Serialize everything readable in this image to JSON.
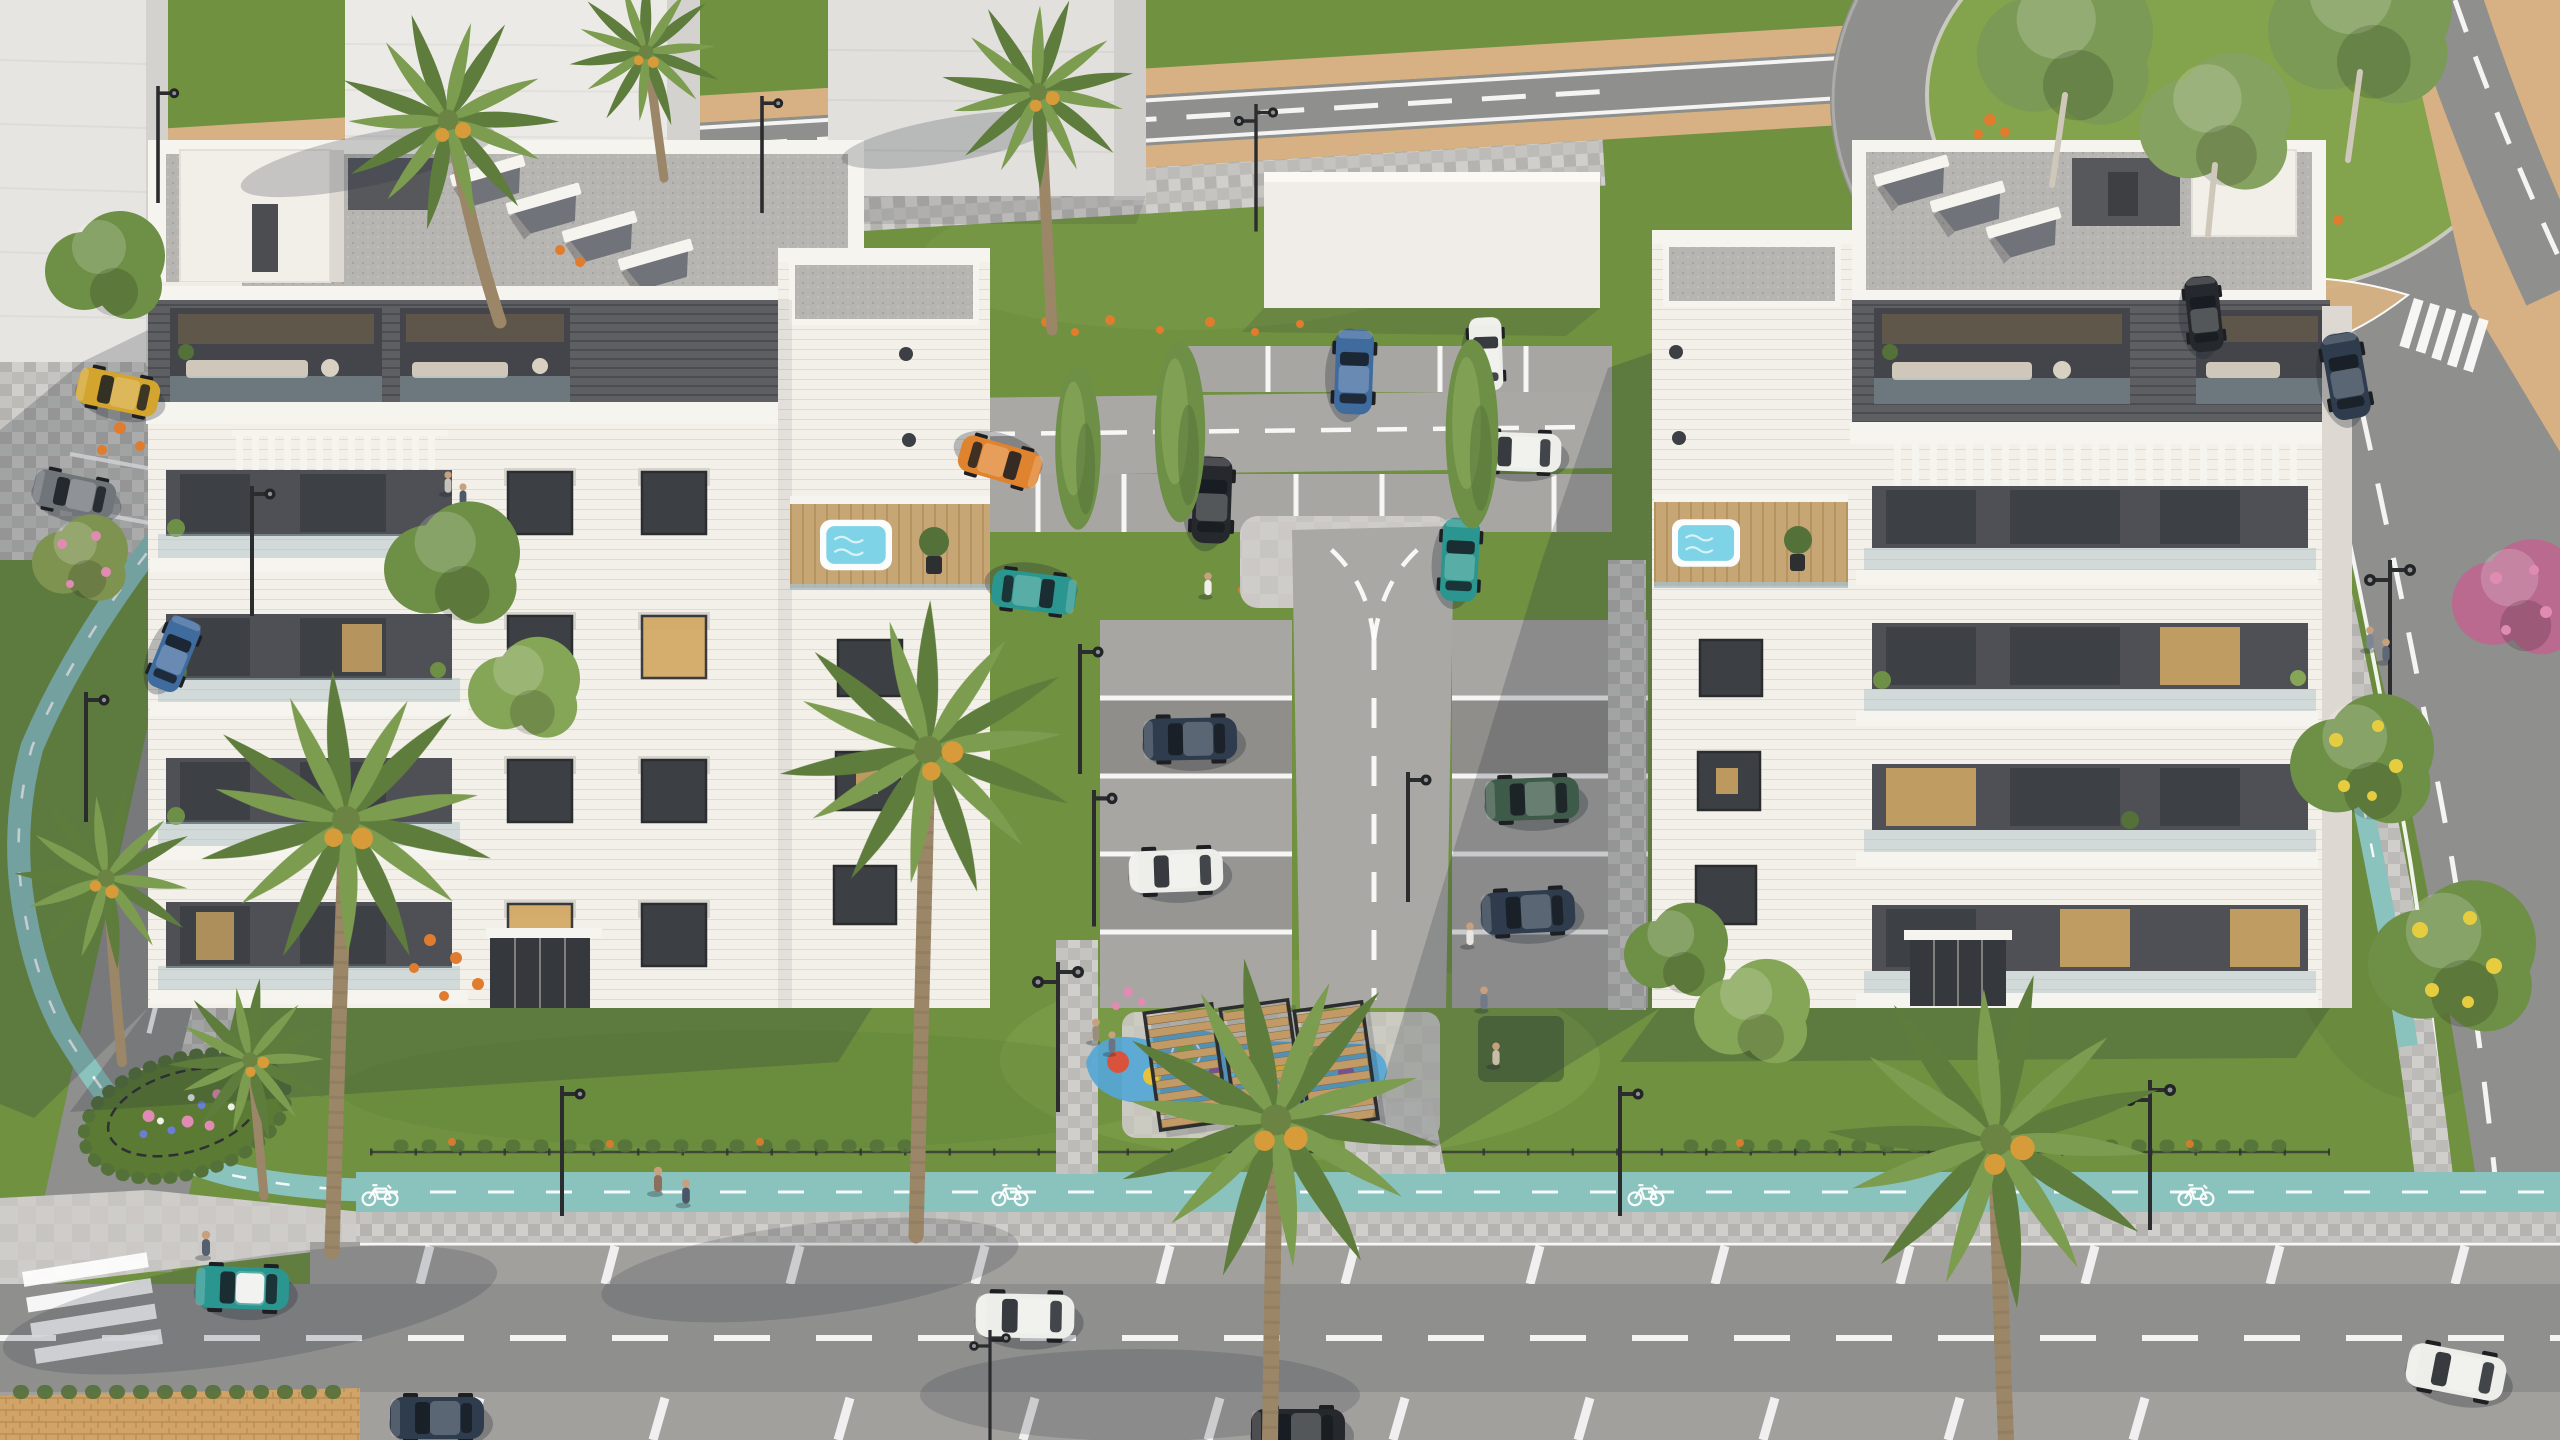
{
  "scene": {
    "title": "Aerial rendering of a residential complex",
    "description": "Photorealistic aerial 3D architectural rendering: two white five-storey apartment buildings with dark-grey penthouse levels, rooftop jacuzzi terraces and balconies, a shared inner courtyard with paved parking, recycling bins, lawns and a colorful playground with wooden pergolas. Surrounded by a boulevard with teal bike lanes, palm trees, a tree-filled roundabout at the top right, sandy median strips, crosswalks, street lamps, parked and driving cars, and pedestrians. No text is visible in the image.",
    "buildings": {
      "count": 2,
      "left_building": "white facade, dark-grey clad upper floors with recessed terraces, rooftop skylights and penthouse volumes, white side tower with jacuzzi terrace, stacked balconies",
      "right_building": "mirrored twin: white tower with jacuzzi terrace on left, dark-grey clad terrace floors, white pergola balcony, window grid with warm lit windows",
      "background_massing": "flat untextured light-grey block buildings along the top edge"
    },
    "landscape": {
      "roundabout": "grass center with eucalyptus trees, top right",
      "bike_lanes": "teal painted lanes with white dashes and bicycle symbols along the bottom boulevard, left road and right road",
      "playground": "blue painted ground game with colored circles under three wooden slatted pergolas",
      "palms": 9,
      "recycling_bins": [
        "orange",
        "green",
        "green"
      ]
    },
    "vehicles": [
      {
        "color": "orange",
        "where": "courtyard bay, left"
      },
      {
        "color": "teal",
        "where": "courtyard, lower left bay"
      },
      {
        "color": "steel-blue SUV",
        "where": "courtyard top bay"
      },
      {
        "color": "white sedan",
        "where": "courtyard road, right"
      },
      {
        "color": "white van",
        "where": "courtyard top right, behind tree"
      },
      {
        "color": "teal",
        "where": "courtyard bay near bins"
      },
      {
        "color": "black SUV",
        "where": "courtyard center bay"
      },
      {
        "color": "navy sedan",
        "where": "Y-road left bay"
      },
      {
        "color": "white sedan",
        "where": "Y-road left bay lower"
      },
      {
        "color": "dark-green SUV",
        "where": "Y-road right bay"
      },
      {
        "color": "navy sedan",
        "where": "Y-road right bay lower"
      },
      {
        "color": "teal with white roof",
        "where": "bottom road left, driving"
      },
      {
        "color": "white SUV",
        "where": "bottom road center, driving"
      },
      {
        "color": "navy",
        "where": "bottom edge parking"
      },
      {
        "color": "dark",
        "where": "bottom edge parking right"
      },
      {
        "color": "white",
        "where": "bottom right road"
      },
      {
        "color": "dark sedan",
        "where": "right road, driving down from roundabout"
      },
      {
        "color": "dark",
        "where": "roundabout exit island"
      },
      {
        "color": "yellow",
        "where": "left street parking"
      },
      {
        "color": "grey",
        "where": "left street parking"
      },
      {
        "color": "blue",
        "where": "left road, driving"
      }
    ]
  },
  "palette": {
    "grass": "#6f9140",
    "grass-light": "#83a34d",
    "grass-dark": "#5b7a34",
    "grass-shade": "#4e6a2d",
    "road": "#8f8f8d",
    "road-dark": "#7b7b7a",
    "court-road": "#aaa8a5",
    "park-pave": "#a2a09d",
    "paver": "#c6c4c0",
    "paver-dark": "#a8a6a2",
    "plaza": "#cfcdc9",
    "bike": "#8ac2bd",
    "bike-dark": "#6fb0ab",
    "sand": "#d7b184",
    "sand-dark": "#c49c69",
    "brick": "#d2a367",
    "white-wall": "#f3f0ea",
    "wall-shade": "#ddd8d1",
    "massing": "#e7e5e2",
    "massing-side": "#d4d2cf",
    "clad": "#5d5f63",
    "clad-dark": "#47494d",
    "gravel": "#b7b5b1",
    "parapet": "#f6f4ef",
    "win-dark": "#3c3f43",
    "win-warm": "#d3a964",
    "glass": "#a9bfc6",
    "deck": "#c7a676",
    "wood": "#c29a66",
    "jacuzzi": "#7ed3e6",
    "tree": "#6d8f46",
    "tree-light": "#85a557",
    "tree-dark": "#54713a",
    "palm": "#7c9c4f",
    "palm-dark": "#5e7d3c",
    "trunk": "#9b8668",
    "pole": "#2b2c2e",
    "fence": "#2f3032",
    "bin-orange": "#e59a33",
    "bin-green": "#7cb14d",
    "car-orange": "#e0832e",
    "car-teal": "#2a968f",
    "car-navy": "#2e3c4e",
    "car-white": "#ededea",
    "car-green": "#3e5a49",
    "car-yellow": "#d3a52e",
    "car-black": "#25282c",
    "car-gray": "#70757a",
    "car-blue": "#3f6b9e",
    "play-blue": "#55a7d6",
    "dot-red": "#d9533c",
    "dot-yellow": "#e8c23c",
    "dot-green": "#74b34c",
    "dot-purple": "#8a5ba6",
    "flower-orange": "#e07c2e",
    "flower-pink": "#e08cb2",
    "flower-yellow": "#e6cc3f",
    "flower-blue": "#6a7fd1",
    "shadow": "rgba(38,44,58,0.22)",
    "white": "#ffffff",
    "skin": "#c9a07f"
  }
}
